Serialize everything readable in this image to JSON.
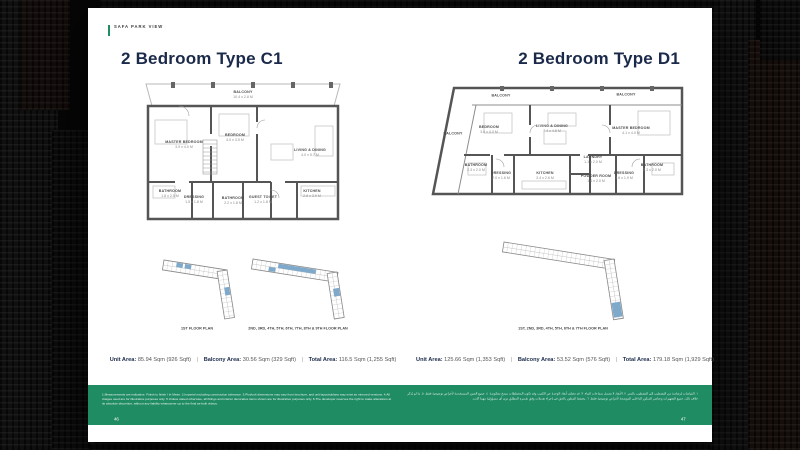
{
  "ui": {
    "separator": "|"
  },
  "brand": {
    "label": "SAFA PARK VIEW"
  },
  "pages": {
    "left": {
      "title": "2 Bedroom Type C1",
      "page_number": "46",
      "floorplan": {
        "balcony": {
          "name": "BALCONY",
          "dims": "10.4 x 2.8 M"
        },
        "rooms": [
          {
            "name": "MASTER BEDROOM",
            "dims": "3.9 x 4.0 M"
          },
          {
            "name": "BEDROOM",
            "dims": "4.0 x 3.5 M"
          },
          {
            "name": "LIVING & DINING",
            "dims": "4.0 x 5.7 M"
          },
          {
            "name": "BATHROOM",
            "dims": "1.8 x 2.5 M"
          },
          {
            "name": "DRESSING",
            "dims": "1.5 x 1.8 M"
          },
          {
            "name": "BATHROOM",
            "dims": "2.2 x 1.8 M"
          },
          {
            "name": "GUEST TOILET",
            "dims": "1.2 x 1.8 M"
          },
          {
            "name": "KITCHEN",
            "dims": "2.8 x 3.9 M"
          }
        ]
      },
      "key_plans": [
        {
          "caption": "1ST FLOOR PLAN"
        },
        {
          "caption": "2ND, 3RD, 4TH, 5TH, 6TH, 7TH, 8TH & 9TH FLOOR PLAN"
        }
      ],
      "stats": [
        {
          "label": "Unit Area:",
          "value": "85.94 Sqm (926 Sqft)"
        },
        {
          "label": "Balcony Area:",
          "value": "30.56 Sqm (329 Sqft)"
        },
        {
          "label": "Total Area:",
          "value": "116.5 Sqm (1,255 Sqft)"
        }
      ]
    },
    "right": {
      "title": "2 Bedroom Type D1",
      "page_number": "47",
      "floorplan": {
        "balconies": [
          {
            "name": "BALCONY"
          },
          {
            "name": "BALCONY"
          },
          {
            "name": "BALCONY"
          }
        ],
        "rooms": [
          {
            "name": "BEDROOM",
            "dims": "3.6 x 4.0 M"
          },
          {
            "name": "LIVING & DINING",
            "dims": "7.4 x 4.5 M"
          },
          {
            "name": "MASTER BEDROOM",
            "dims": "4.1 x 4.0 M"
          },
          {
            "name": "BATHROOM",
            "dims": "2.3 x 2.0 M"
          },
          {
            "name": "DRESSING",
            "dims": "2.0 x 1.6 M"
          },
          {
            "name": "KITCHEN",
            "dims": "3.4 x 2.6 M"
          },
          {
            "name": "LAUNDRY",
            "dims": "1.1 x 2.0 M"
          },
          {
            "name": "POWDER ROOM",
            "dims": "1.4 x 2.0 M"
          },
          {
            "name": "DRESSING",
            "dims": "1.6 x 1.9 M"
          },
          {
            "name": "BATHROOM",
            "dims": "2.3 x 2.0 M"
          }
        ]
      },
      "key_plans": [
        {
          "caption": "1ST, 2ND, 3RD, 4TH, 5TH, 6TH & 7TH FLOOR PLAN"
        }
      ],
      "stats": [
        {
          "label": "Unit Area:",
          "value": "125.66 Sqm (1,353 Sqft)"
        },
        {
          "label": "Balcony Area:",
          "value": "53.52 Sqm (576 Sqft)"
        },
        {
          "label": "Total Area:",
          "value": "179.18 Sqm (1,929 Sqft)"
        }
      ]
    }
  },
  "footer": {
    "disclaimer_en": "1.Measurements are indicative. Finish to finish / In Meter. 2.Imperial excluding construction tolerance. 3.Plot/unit dimensions may vary from brochure, and unit layouts/plans may exist as mirrored versions. 4.All images used are for illustrative purposes only. 5.Unless stated otherwise, all fittings and interior decorative items shown are for illustrative purposes only. 6.The developer reserves the right to make alterations at its absolute discretion, without any liability whatsoever up to the final as-built videos.",
    "disclaimer_ar": "١. القياسات إرشادية من التشطيب إلى التشطيب بالمتر. ٢. الأبعاد لا تشمل سماحات البناء. ٣. قد تختلف أبعاد الوحدة عن الكتيب وقد تكون المخططات بنسخ معكوسة. ٤. جميع الصور المستخدمة لأغراض توضيحية فقط. ٥. ما لم يُذكر خلاف ذلك، جميع التجهيزات وعناصر الديكور الداخلي الموضحة لأغراض توضيحية فقط. ٦. يحتفظ المطور بالحق في إجراء تعديلات وفق تقديره المطلق دون أي مسؤولية مهما كانت."
  },
  "colors": {
    "accent_green": "#208C64",
    "title_navy": "#1B2A4A",
    "keyplan_blue": "#7FA9CA"
  }
}
